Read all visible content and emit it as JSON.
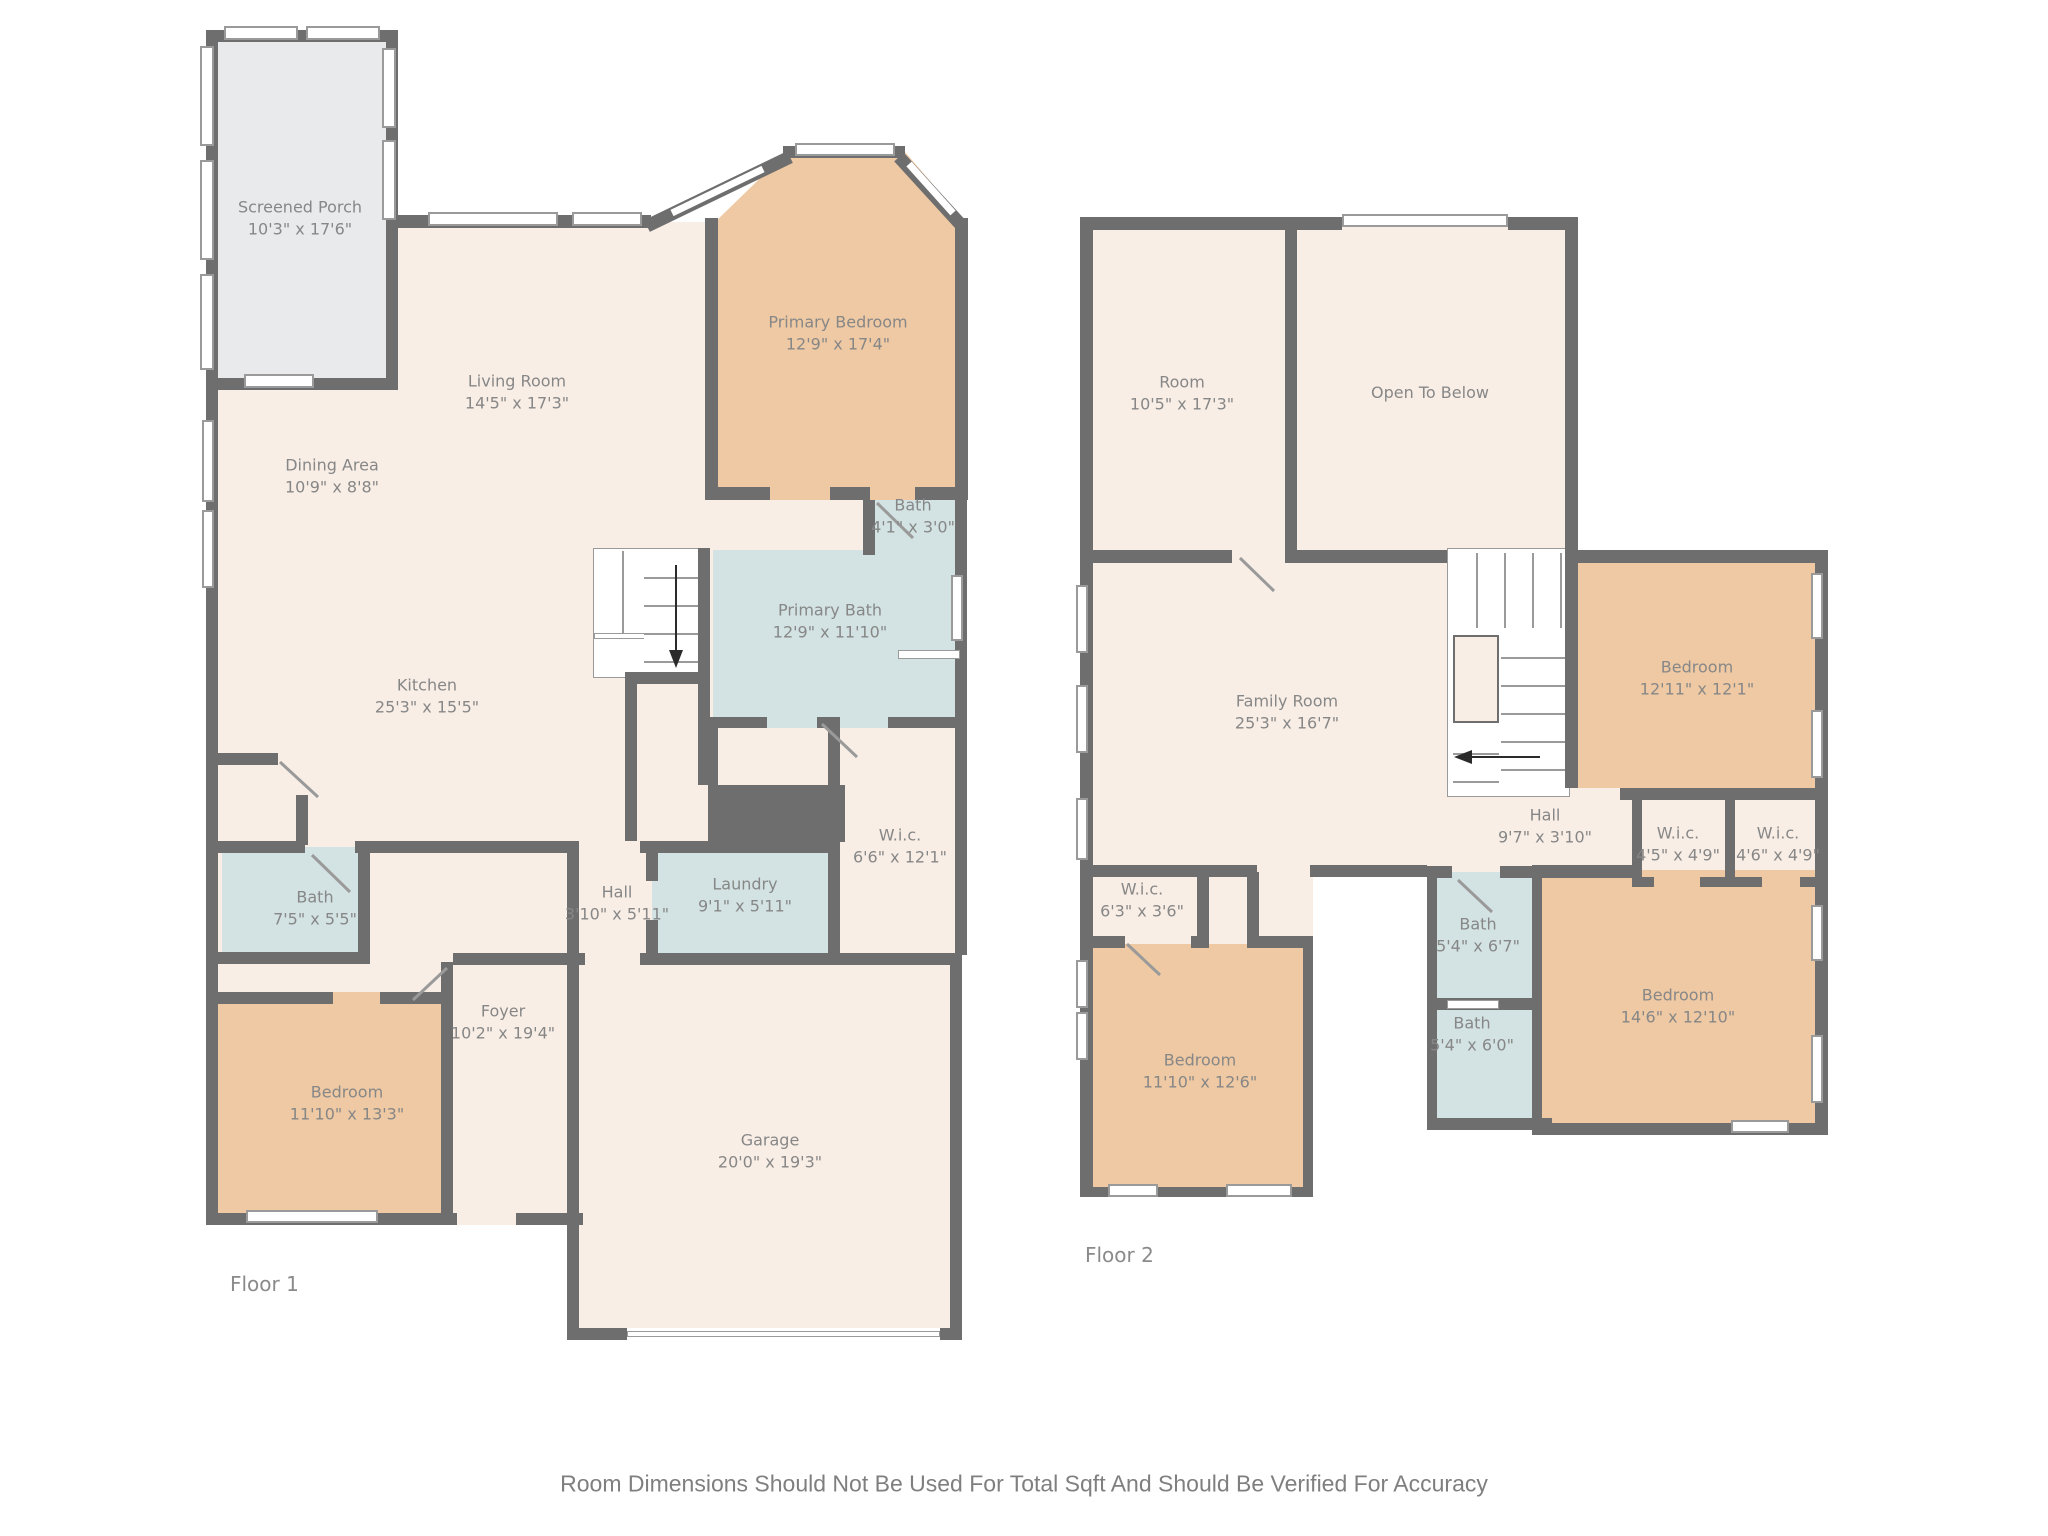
{
  "footer": {
    "disclaimer": "Room Dimensions Should Not Be Used For Total Sqft And Should Be Verified For Accuracy"
  },
  "palette": {
    "wall": "#6e6e6e",
    "floor_cream": "#f8eee6",
    "floor_orange": "#eec9a3",
    "floor_blue": "#d3e2e2",
    "floor_porch": "#e9eaec",
    "label_text": "#878787"
  },
  "floor1": {
    "label": "Floor 1",
    "rooms": [
      {
        "name": "Screened Porch",
        "dims": "10'3\" x 17'6\""
      },
      {
        "name": "Living Room",
        "dims": "14'5\" x 17'3\""
      },
      {
        "name": "Dining Area",
        "dims": "10'9\" x 8'8\""
      },
      {
        "name": "Kitchen",
        "dims": "25'3\" x 15'5\""
      },
      {
        "name": "Primary Bedroom",
        "dims": "12'9\" x 17'4\""
      },
      {
        "name": "Bath",
        "dims": "4'1\" x 3'0\""
      },
      {
        "name": "Primary Bath",
        "dims": "12'9\" x 11'10\""
      },
      {
        "name": "W.i.c.",
        "dims": "6'6\" x 12'1\""
      },
      {
        "name": "Hall",
        "dims": "3'10\" x 5'11\""
      },
      {
        "name": "Laundry",
        "dims": "9'1\" x 5'11\""
      },
      {
        "name": "Bath",
        "dims": "7'5\" x 5'5\""
      },
      {
        "name": "Bedroom",
        "dims": "11'10\" x 13'3\""
      },
      {
        "name": "Foyer",
        "dims": "10'2\" x 19'4\""
      },
      {
        "name": "Garage",
        "dims": "20'0\" x 19'3\""
      }
    ]
  },
  "floor2": {
    "label": "Floor 2",
    "rooms": [
      {
        "name": "Room",
        "dims": "10'5\" x 17'3\""
      },
      {
        "name": "Open To Below",
        "dims": ""
      },
      {
        "name": "Family Room",
        "dims": "25'3\" x 16'7\""
      },
      {
        "name": "Hall",
        "dims": "9'7\" x 3'10\""
      },
      {
        "name": "Bedroom",
        "dims": "12'11\" x 12'1\""
      },
      {
        "name": "W.i.c.",
        "dims": "4'5\" x 4'9\""
      },
      {
        "name": "W.i.c.",
        "dims": "4'6\" x 4'9\""
      },
      {
        "name": "W.i.c.",
        "dims": "6'3\" x 3'6\""
      },
      {
        "name": "Bath",
        "dims": "5'4\" x 6'7\""
      },
      {
        "name": "Bath",
        "dims": "5'4\" x 6'0\""
      },
      {
        "name": "Bedroom",
        "dims": "11'10\" x 12'6\""
      },
      {
        "name": "Bedroom",
        "dims": "14'6\" x 12'10\""
      }
    ]
  }
}
